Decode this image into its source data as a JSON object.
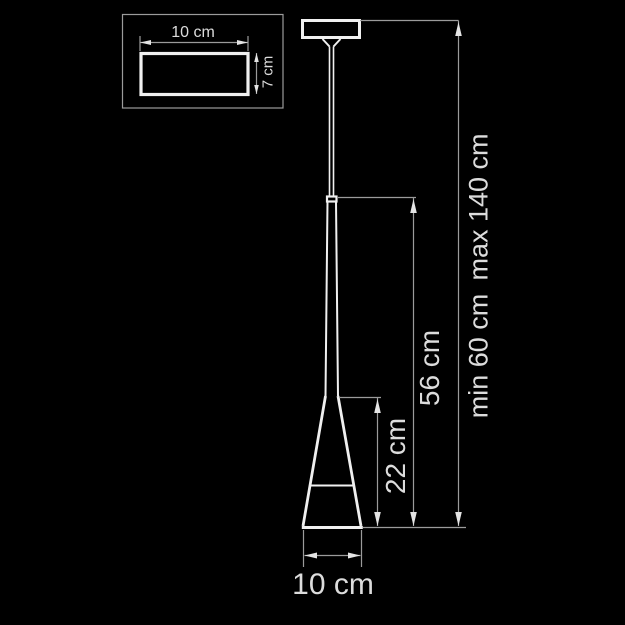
{
  "colors": {
    "background": "#000000",
    "figure_line": "#f0f0f0",
    "dimension_line": "#9b9b9b",
    "arrow_fill": "#e4e4e4",
    "label_text": "#dcdcdc"
  },
  "inset": {
    "width_label": "10 cm",
    "height_label": "7 cm"
  },
  "main": {
    "shade_height_label": "22 cm",
    "fixture_height_label": "56 cm",
    "suspension_min_label": "min 60 cm",
    "suspension_max_label": "max 140 cm",
    "shade_diameter_label": "10 cm"
  }
}
